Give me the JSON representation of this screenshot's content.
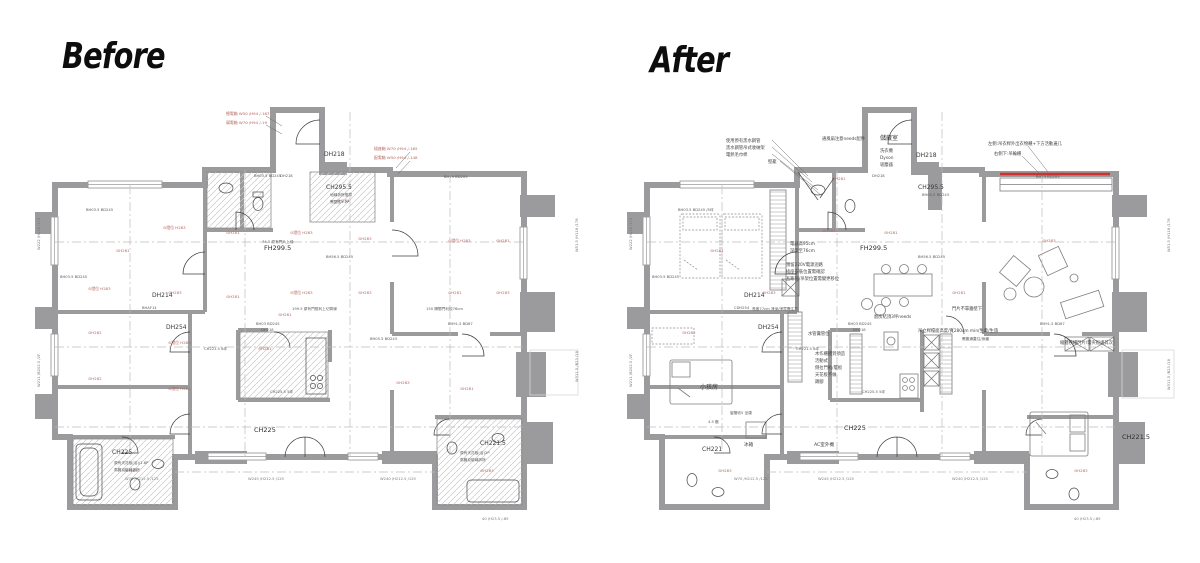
{
  "titles": {
    "before": "Before",
    "after": "After"
  },
  "colors": {
    "wall_gray": "#9b9b9d",
    "annotation_red": "#b5645c",
    "highlight_red": "#d03030",
    "line_black": "#3c3c3c",
    "dash_gray": "#bcbcbc"
  },
  "before": {
    "labels": {
      "fh299": "FH299.5",
      "ch2955": "CH295.5",
      "dh218": "DH218",
      "dh214": "DH214",
      "dh254": "DH254",
      "ch225_hall": "CH225",
      "ch225_bath": "CH225",
      "ch2215_bath": "CH221.5"
    },
    "red_notes": [
      {
        "x": 196,
        "y": 33,
        "t": "總電箱 W50 /H94 /-167"
      },
      {
        "x": 196,
        "y": 42,
        "t": "弱電箱 W70 /H94 /-19"
      },
      {
        "x": 344,
        "y": 68,
        "t": "插座箱 W70 /H94 /-165"
      },
      {
        "x": 344,
        "y": 77,
        "t": "配電箱 W50 /H94 /-148"
      }
    ],
    "red_marks": [
      {
        "x": 133,
        "y": 147,
        "t": "⊙燈位 H283"
      },
      {
        "x": 196,
        "y": 152,
        "t": "⊙H281"
      },
      {
        "x": 260,
        "y": 152,
        "t": "⊙燈位 H283"
      },
      {
        "x": 328,
        "y": 158,
        "t": "⊙H283"
      },
      {
        "x": 418,
        "y": 160,
        "t": "⊙燈位 H283"
      },
      {
        "x": 466,
        "y": 160,
        "t": "⊙H281"
      },
      {
        "x": 86,
        "y": 170,
        "t": "⊙H281"
      },
      {
        "x": 58,
        "y": 208,
        "t": "⊙燈位 H283"
      },
      {
        "x": 138,
        "y": 212,
        "t": "⊙H283"
      },
      {
        "x": 196,
        "y": 216,
        "t": "⊙H281"
      },
      {
        "x": 260,
        "y": 212,
        "t": "⊙燈位 H283"
      },
      {
        "x": 328,
        "y": 212,
        "t": "⊙H283"
      },
      {
        "x": 418,
        "y": 212,
        "t": "⊙H281"
      },
      {
        "x": 466,
        "y": 212,
        "t": "⊙H283"
      },
      {
        "x": 58,
        "y": 252,
        "t": "⊙H282"
      },
      {
        "x": 138,
        "y": 262,
        "t": "⊙燈位 H283"
      },
      {
        "x": 228,
        "y": 268,
        "t": "⊙H281"
      },
      {
        "x": 58,
        "y": 298,
        "t": "⊙H282"
      },
      {
        "x": 138,
        "y": 308,
        "t": "⊙燈位 H283"
      },
      {
        "x": 366,
        "y": 302,
        "t": "⊙H283"
      },
      {
        "x": 430,
        "y": 308,
        "t": "⊙H281"
      },
      {
        "x": 94,
        "y": 390,
        "t": "⊙H283"
      },
      {
        "x": 450,
        "y": 390,
        "t": "⊙H283"
      },
      {
        "x": 306,
        "y": 120,
        "t": "⊙H281"
      },
      {
        "x": 248,
        "y": 234,
        "t": "⊙H281"
      }
    ],
    "codes": [
      {
        "x": 224,
        "y": 95,
        "t": "BH03.5 BD245"
      },
      {
        "x": 414,
        "y": 96,
        "t": "BH79 BD205"
      },
      {
        "x": 296,
        "y": 176,
        "t": "BH56.5 BD245"
      },
      {
        "x": 226,
        "y": 243,
        "t": "BH03 BD245"
      },
      {
        "x": 174,
        "y": 268,
        "t": "CH221.5 8坪"
      },
      {
        "x": 418,
        "y": 243,
        "t": "BH91.5 BD67"
      },
      {
        "x": 56,
        "y": 129,
        "t": "BH03.5 BD245"
      },
      {
        "x": 30,
        "y": 196,
        "t": "BH03.5 BD245"
      },
      {
        "x": 250,
        "y": 95,
        "t": "DH218"
      },
      {
        "x": 231,
        "y": 249,
        "t": "DH218"
      },
      {
        "x": 240,
        "y": 311,
        "t": "CH225.5 5坪"
      },
      {
        "x": 232,
        "y": 161,
        "t": "74.5 原有門片上緣"
      },
      {
        "x": 262,
        "y": 228,
        "t": "199.5 原有門框利上切齊線"
      },
      {
        "x": 396,
        "y": 228,
        "t": "150 隔間門利梳76cm"
      },
      {
        "x": 300,
        "y": 114,
        "t": "地磚拆除復原"
      },
      {
        "x": 300,
        "y": 121,
        "t": "需整區1.2P"
      },
      {
        "x": 84,
        "y": 382,
        "t": "原有天花板(浴)/1.8P"
      },
      {
        "x": 84,
        "y": 389,
        "t": "馬賽克磁磚拆除"
      },
      {
        "x": 430,
        "y": 372,
        "t": "原有天花板(浴)2P"
      },
      {
        "x": 430,
        "y": 379,
        "t": "馬賽克磁磚拆除"
      },
      {
        "x": 112,
        "y": 227,
        "t": "BHAF14"
      },
      {
        "x": 340,
        "y": 258,
        "t": "BH05.5 BD243"
      }
    ],
    "dims": [
      {
        "x": 95,
        "y": 398,
        "t": "W70 /H212.5  /125"
      },
      {
        "x": 218,
        "y": 398,
        "t": "W245 /H212.5  /125"
      },
      {
        "x": 350,
        "y": 398,
        "t": "W240 /H212.5  /125"
      },
      {
        "x": 452,
        "y": 438,
        "t": "40 /H23.5  /-89"
      },
      {
        "x": 10,
        "y": 168,
        "t": "W222 /H118 /178",
        "r": -90
      },
      {
        "x": 10,
        "y": 305,
        "t": "W211 /B202.5 /2F",
        "r": -90
      },
      {
        "x": 548,
        "y": 170,
        "t": "W51.5 /H118 /178",
        "r": -90
      },
      {
        "x": 548,
        "y": 300,
        "t": "W311.5 /B23 /18",
        "r": -90
      }
    ]
  },
  "after": {
    "labels": {
      "fh299": "FH299.5",
      "ch2955": "CH295.5",
      "dh218": "DH218",
      "storage": "儲藏室",
      "dh214": "DH214",
      "dh254": "DH254",
      "ch225_hall": "CH225",
      "ch221_bath": "CH221",
      "ch2215_bath": "CH221.5",
      "kids_room": "小孩房",
      "fridge": "冰箱",
      "ac_unit": "AC室外機"
    },
    "notes": [
      {
        "x": 104,
        "y": 60,
        "t": "使用原有黑水鋼管"
      },
      {
        "x": 104,
        "y": 67,
        "t": "黑水鋼管吊式收納架"
      },
      {
        "x": 104,
        "y": 74,
        "t": "電熱毛巾桿"
      },
      {
        "x": 146,
        "y": 81,
        "t": "壁龕"
      },
      {
        "x": 258,
        "y": 70,
        "t": "洗衣機"
      },
      {
        "x": 258,
        "y": 77,
        "t": "Dyson"
      },
      {
        "x": 258,
        "y": 84,
        "t": "吸塵器"
      },
      {
        "x": 366,
        "y": 63,
        "t": "左側:吊衣桿外出衣物櫃+下方活動邊几"
      },
      {
        "x": 372,
        "y": 73,
        "t": "右側下:吊輪櫃"
      },
      {
        "x": 168,
        "y": 163,
        "t": "電器高95cm"
      },
      {
        "x": 168,
        "y": 170,
        "t": "深度至76cm"
      },
      {
        "x": 164,
        "y": 184,
        "t": "預留220V電源迴路"
      },
      {
        "x": 164,
        "y": 191,
        "t": "插座安裝位置需確認"
      },
      {
        "x": 164,
        "y": 198,
        "t": "瓦斯管/吊架位置需變更移位"
      },
      {
        "x": 330,
        "y": 228,
        "t": "門片不靠牆壁下"
      },
      {
        "x": 186,
        "y": 253,
        "t": "水管糞管位"
      },
      {
        "x": 193,
        "y": 273,
        "t": "木作櫃體到頂造"
      },
      {
        "x": 193,
        "y": 280,
        "t": "活動式"
      },
      {
        "x": 193,
        "y": 287,
        "t": "側拉門軌/層板"
      },
      {
        "x": 193,
        "y": 294,
        "t": "天花板不做"
      },
      {
        "x": 193,
        "y": 301,
        "t": "踢腳"
      },
      {
        "x": 252,
        "y": 236,
        "t": "廚房結頂3坪needs"
      },
      {
        "x": 296,
        "y": 250,
        "t": "吊立桿檯面高度/寬280cm min/生菓/生旅"
      },
      {
        "x": 438,
        "y": 262,
        "t": "縮體移櫃門片/需夾板處其次"
      },
      {
        "x": 200,
        "y": 58,
        "t": "通風扇注意needs配件"
      }
    ],
    "red_marks": [
      {
        "x": 200,
        "y": 150,
        "t": "⊙H283"
      },
      {
        "x": 262,
        "y": 152,
        "t": "⊙H281"
      },
      {
        "x": 420,
        "y": 160,
        "t": "⊙H283"
      },
      {
        "x": 88,
        "y": 170,
        "t": "⊙H281"
      },
      {
        "x": 140,
        "y": 212,
        "t": "⊙H283"
      },
      {
        "x": 330,
        "y": 212,
        "t": "⊙H281"
      },
      {
        "x": 60,
        "y": 252,
        "t": "⊙H282"
      },
      {
        "x": 96,
        "y": 390,
        "t": "⊙H283"
      },
      {
        "x": 452,
        "y": 390,
        "t": "⊙H283"
      },
      {
        "x": 210,
        "y": 98,
        "t": "⊙H281"
      }
    ],
    "codes": [
      {
        "x": 56,
        "y": 129,
        "t": "BH03.5 BD245  /5坪"
      },
      {
        "x": 414,
        "y": 96,
        "t": "BH79 BD205"
      },
      {
        "x": 296,
        "y": 176,
        "t": "BH56.5 BD245"
      },
      {
        "x": 226,
        "y": 243,
        "t": "BH03 BD245"
      },
      {
        "x": 174,
        "y": 268,
        "t": "CH221.5 8坪"
      },
      {
        "x": 30,
        "y": 196,
        "t": "BH03.5 BD245"
      },
      {
        "x": 250,
        "y": 95,
        "t": "DH218"
      },
      {
        "x": 231,
        "y": 249,
        "t": "DH218"
      },
      {
        "x": 240,
        "y": 311,
        "t": "CH225.5 5坪"
      },
      {
        "x": 130,
        "y": 228,
        "t": "長度77cm 淨深/淨寬需注意"
      },
      {
        "x": 300,
        "y": 114,
        "t": "BH05.5 BD243"
      },
      {
        "x": 418,
        "y": 243,
        "t": "BH91.5 BD67"
      },
      {
        "x": 112,
        "y": 227,
        "t": "CDH254"
      },
      {
        "x": 340,
        "y": 258,
        "t": "需靠通蓋住/身藏"
      },
      {
        "x": 86,
        "y": 341,
        "t": "4.5 壓"
      },
      {
        "x": 108,
        "y": 332,
        "t": "窗檯收5 坐康"
      }
    ],
    "dims": [
      {
        "x": 112,
        "y": 398,
        "t": "W70  /H212.5  /125"
      },
      {
        "x": 196,
        "y": 398,
        "t": "W245 /H212.5  /125"
      },
      {
        "x": 330,
        "y": 398,
        "t": "W240 /H212.5  /125"
      },
      {
        "x": 452,
        "y": 438,
        "t": "40 /H23.5  /-89"
      },
      {
        "x": 10,
        "y": 168,
        "t": "W222 /H118 /178",
        "r": -90
      },
      {
        "x": 10,
        "y": 305,
        "t": "W211 /B202.5 /2F",
        "r": -90
      },
      {
        "x": 548,
        "y": 170,
        "t": "W51.5 /H118 /178",
        "r": -90
      },
      {
        "x": 548,
        "y": 308,
        "t": "W311.5 /B23 /18",
        "r": -90
      }
    ]
  }
}
